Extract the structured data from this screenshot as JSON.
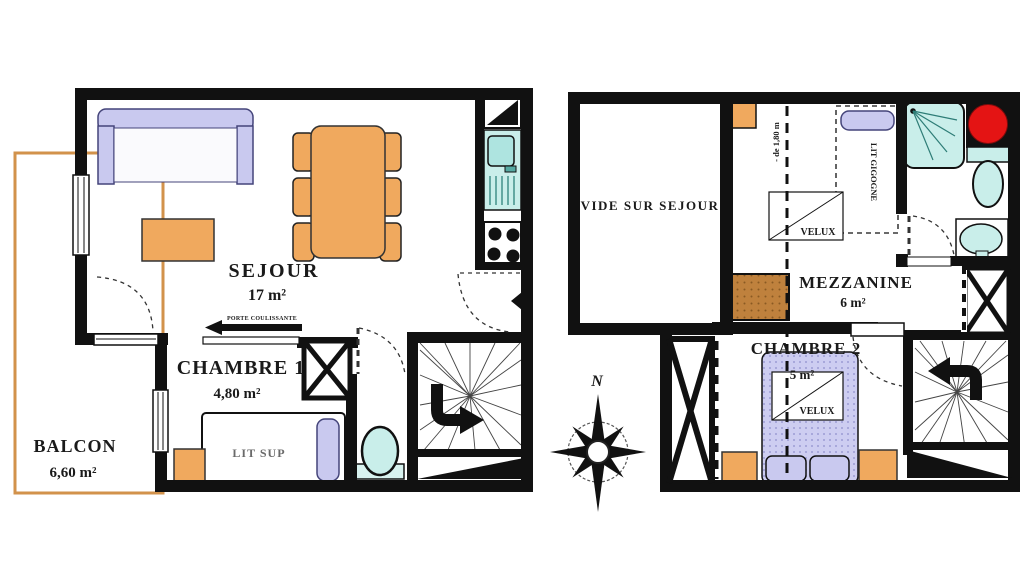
{
  "colors": {
    "wall": "#111111",
    "furniture_orange": "#f0a95e",
    "upholstery_lavender": "#c9c9ef",
    "fixture_cyan": "#c9eeea",
    "balcony_outline": "#d2924b",
    "commode_brown": "#bf813d",
    "alert_red": "#e41414"
  },
  "level1": {
    "sejour": {
      "name": "SEJOUR",
      "area": "17 m²"
    },
    "chambre1": {
      "name": "CHAMBRE 1",
      "area": "4,80 m²"
    },
    "balcon": {
      "name": "BALCON",
      "area": "6,60 m²"
    },
    "bed_label": "LIT SUP",
    "sliding_door_label": "PORTE COULISSANTE"
  },
  "level2": {
    "vide_sur_sejour": "VIDE SUR SEJOUR",
    "mezzanine": {
      "name": "MEZZANINE",
      "area": "6 m²"
    },
    "chambre2": {
      "name": "CHAMBRE 2",
      "area": "5 m²"
    },
    "velux_label": "VELUX",
    "bed_label": "LIT GIGOGNE",
    "height_note": "- de 1,80 m"
  },
  "compass": {
    "north_label": "N"
  }
}
